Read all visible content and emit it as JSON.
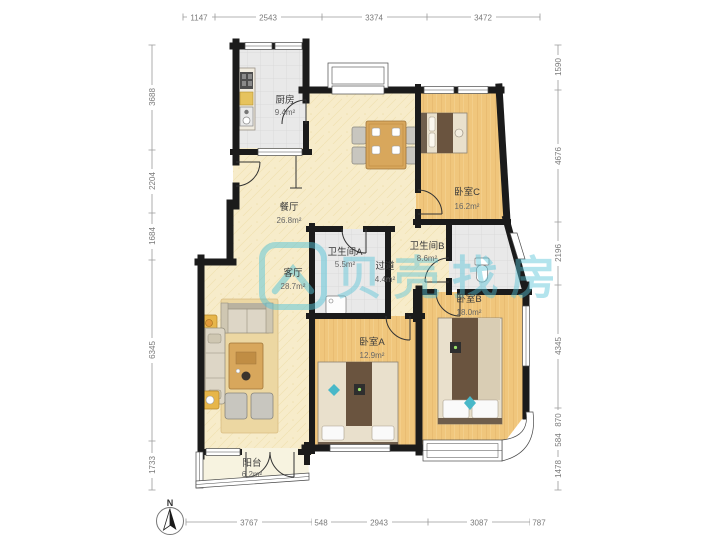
{
  "app": {
    "type": "residential-floor-plan"
  },
  "watermark": {
    "text": "贝壳找房"
  },
  "compass": {
    "label": "N"
  },
  "rooms": {
    "kitchen": {
      "name": "厨房",
      "area": "9.4m²"
    },
    "dining": {
      "name": "餐厅",
      "area": "26.8m²"
    },
    "living": {
      "name": "客厅",
      "area": "28.7m²"
    },
    "bathA": {
      "name": "卫生间A",
      "area": "5.5m²"
    },
    "hallway": {
      "name": "过道",
      "area": "4.4m²"
    },
    "bathB": {
      "name": "卫生间B",
      "area": "8.6m²"
    },
    "bedC": {
      "name": "卧室C",
      "area": "16.2m²"
    },
    "bedB": {
      "name": "卧室B",
      "area": "18.0m²"
    },
    "bedA": {
      "name": "卧室A",
      "area": "12.9m²"
    },
    "balcony": {
      "name": "阳台",
      "area": "6.2m²"
    }
  },
  "dimensions": {
    "top": [
      "1147",
      "2543",
      "3374",
      "3472"
    ],
    "left": [
      "3688",
      "2204",
      "1684",
      "6345",
      "1733"
    ],
    "right": [
      "1590",
      "4676",
      "2196",
      "4345",
      "870",
      "584",
      "1478"
    ],
    "bottom": [
      "3767",
      "548",
      "2943",
      "3087",
      "787"
    ]
  },
  "colors": {
    "wall": "#1b1b1b",
    "wood_floor": "#f0c67c",
    "tile_floor": "#e9e9e9",
    "main_floor": "#f7ecca",
    "balcony_floor": "#f7f3e0",
    "watermark_teal": "#56c4d8",
    "furniture_wood": "#d8a75c",
    "blanket_brown": "#6a543f",
    "accent_teal": "#49b8c8"
  }
}
